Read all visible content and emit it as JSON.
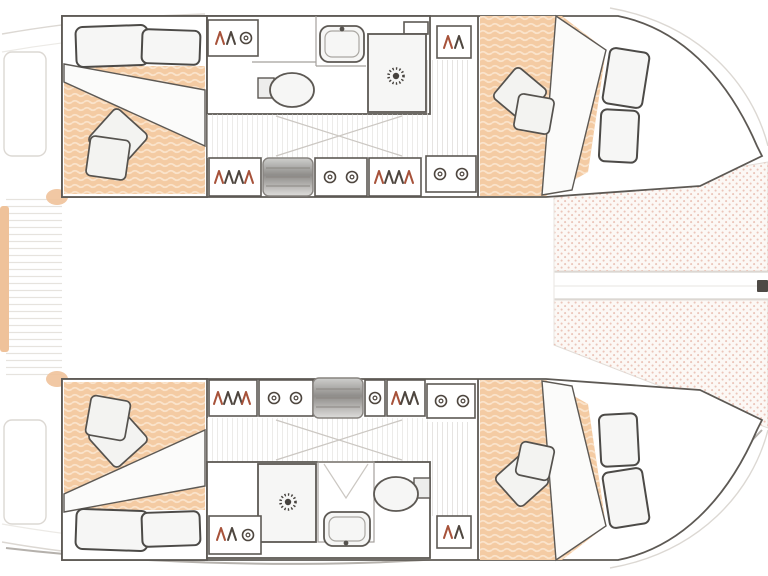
{
  "page": {
    "title": "Catamaran 4-cabin layout floor plan",
    "view": "top-down deck plan, bow to the right, no visible text labels"
  },
  "colors": {
    "wall": "#5d5954",
    "faint": "#dcd8d3",
    "mattress": "#f4cba3",
    "mattress-wave": "#fae3cb",
    "tramp-bg": "#fcf8f5",
    "tramp-dot": "#e8bcae",
    "fixture-fill": "#f6f6f5",
    "glyph-red": "#a7523a",
    "glyph-dark": "#4e463f",
    "slat": "#d9d6d2",
    "accent-orange": "#efc29a"
  },
  "legend": {
    "upper_hull": {
      "aft_cabin": [
        "double berth with wavy mattress",
        "2 head pillows",
        "2 throw pillows",
        "folded duvet"
      ],
      "bathroom": [
        "washbasin with faucet",
        "toilet",
        "shower stall with sun-burst drain",
        "shelf"
      ],
      "companionway": [
        "hanging locker (hanger symbols)",
        "gray companionway steps",
        "locker with ring latches",
        "second hanging locker",
        "second ring locker",
        "slatted floor",
        "door swing lines"
      ],
      "forward_cabin": [
        "tapered double berth",
        "2 bow pillows",
        "2 throw pillows",
        "hanging locker",
        "white duvet fold"
      ]
    },
    "lower_hull": {
      "aft_cabin": [
        "double berth with wavy mattress",
        "2 head pillows",
        "2 throw pillows",
        "folded duvet"
      ],
      "bathroom": [
        "washbasin with faucet",
        "toilet",
        "shower stall with sun-burst drain",
        "changing stall"
      ],
      "companionway": [
        "hanging lockers",
        "gray companionway steps",
        "ring lockers",
        "slatted floor",
        "door swing lines"
      ],
      "forward_cabin": [
        "tapered double berth",
        "2 bow pillows",
        "2 throw pillows",
        "hanging locker",
        "white duvet fold"
      ]
    },
    "deck": {
      "bow": [
        "upper trampoline net (dotted)",
        "lower trampoline net (dotted)",
        "central forebeam walkway",
        "bow fitting"
      ],
      "stern": [
        "slatted swim/stern platform",
        "cockpit seats (faint outline)",
        "orange side pads"
      ],
      "bridgedeck": [
        "open saloon area (blank)"
      ]
    }
  }
}
